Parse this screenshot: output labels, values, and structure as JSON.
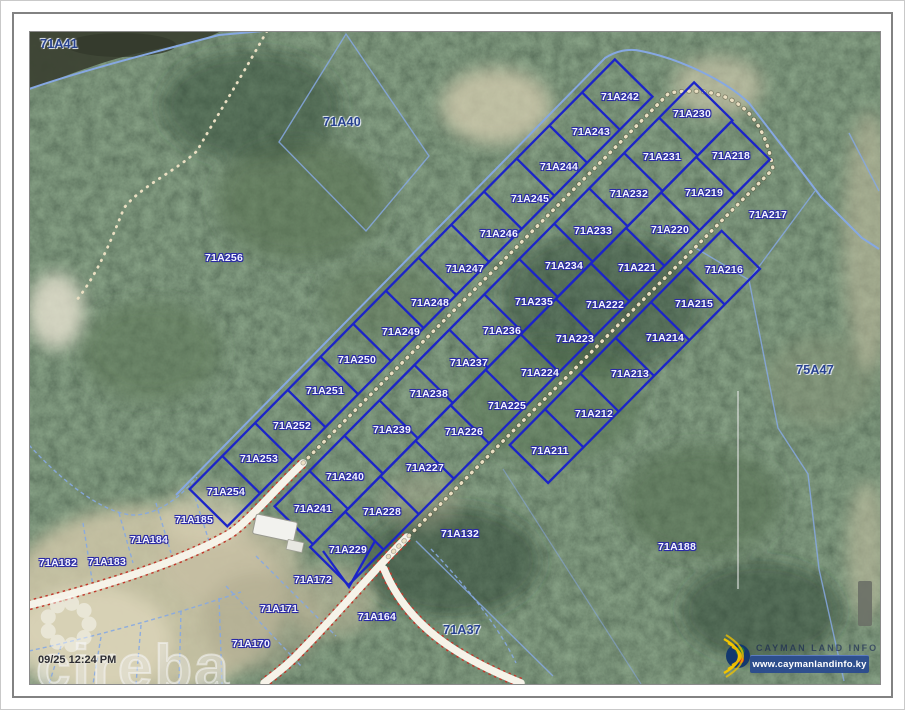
{
  "document": {
    "timestamp": "09/25 12:24 PM"
  },
  "watermark": {
    "brand": "cireba"
  },
  "branding": {
    "logo_text": "CAYMAN LAND INFO",
    "website": "www.caymanlandinfo.ky"
  },
  "colors": {
    "forest": "#41563f",
    "water": "#3c4233",
    "sand": "#d3cbae",
    "lot_boundary": "#1c24c8",
    "parcel_boundary": "#86a8e2",
    "road_fill": "#f6f3e9",
    "road_edge": "#c03a2c",
    "trail_dots": "#eadfc2",
    "label_minor": "#f5f5ff",
    "label_major": "#27418f"
  },
  "map": {
    "parcel_labels": [
      {
        "id": "71A41",
        "x": 57,
        "y": 42,
        "style": "major"
      },
      {
        "id": "71A40",
        "x": 340,
        "y": 120,
        "style": "major"
      },
      {
        "id": "71A256",
        "x": 222,
        "y": 256
      },
      {
        "id": "71A242",
        "x": 618,
        "y": 95
      },
      {
        "id": "71A230",
        "x": 690,
        "y": 112
      },
      {
        "id": "71A243",
        "x": 589,
        "y": 130
      },
      {
        "id": "71A231",
        "x": 660,
        "y": 155
      },
      {
        "id": "71A218",
        "x": 729,
        "y": 154
      },
      {
        "id": "71A244",
        "x": 557,
        "y": 165
      },
      {
        "id": "71A232",
        "x": 627,
        "y": 192
      },
      {
        "id": "71A219",
        "x": 702,
        "y": 191
      },
      {
        "id": "71A245",
        "x": 528,
        "y": 197
      },
      {
        "id": "71A217",
        "x": 766,
        "y": 213
      },
      {
        "id": "71A233",
        "x": 591,
        "y": 229
      },
      {
        "id": "71A220",
        "x": 668,
        "y": 228
      },
      {
        "id": "71A246",
        "x": 497,
        "y": 232
      },
      {
        "id": "71A247",
        "x": 463,
        "y": 267
      },
      {
        "id": "71A234",
        "x": 562,
        "y": 264
      },
      {
        "id": "71A221",
        "x": 635,
        "y": 266
      },
      {
        "id": "71A216",
        "x": 722,
        "y": 268
      },
      {
        "id": "71A248",
        "x": 428,
        "y": 301
      },
      {
        "id": "71A235",
        "x": 532,
        "y": 300
      },
      {
        "id": "71A222",
        "x": 603,
        "y": 303
      },
      {
        "id": "71A215",
        "x": 692,
        "y": 302
      },
      {
        "id": "71A249",
        "x": 399,
        "y": 330
      },
      {
        "id": "71A236",
        "x": 500,
        "y": 329
      },
      {
        "id": "71A223",
        "x": 573,
        "y": 337
      },
      {
        "id": "71A214",
        "x": 663,
        "y": 336
      },
      {
        "id": "71A250",
        "x": 355,
        "y": 358
      },
      {
        "id": "71A237",
        "x": 467,
        "y": 361
      },
      {
        "id": "71A224",
        "x": 538,
        "y": 371
      },
      {
        "id": "71A213",
        "x": 628,
        "y": 372
      },
      {
        "id": "71A251",
        "x": 323,
        "y": 389
      },
      {
        "id": "71A238",
        "x": 427,
        "y": 392
      },
      {
        "id": "71A225",
        "x": 505,
        "y": 404
      },
      {
        "id": "71A212",
        "x": 592,
        "y": 412
      },
      {
        "id": "71A252",
        "x": 290,
        "y": 424
      },
      {
        "id": "71A239",
        "x": 390,
        "y": 428
      },
      {
        "id": "71A226",
        "x": 462,
        "y": 430
      },
      {
        "id": "71A253",
        "x": 257,
        "y": 457
      },
      {
        "id": "71A240",
        "x": 343,
        "y": 475
      },
      {
        "id": "71A227",
        "x": 423,
        "y": 466
      },
      {
        "id": "71A211",
        "x": 548,
        "y": 449
      },
      {
        "id": "71A254",
        "x": 224,
        "y": 490
      },
      {
        "id": "71A241",
        "x": 311,
        "y": 507
      },
      {
        "id": "71A228",
        "x": 380,
        "y": 510
      },
      {
        "id": "71A229",
        "x": 346,
        "y": 548
      },
      {
        "id": "71A185",
        "x": 192,
        "y": 518
      },
      {
        "id": "71A184",
        "x": 147,
        "y": 538
      },
      {
        "id": "71A183",
        "x": 105,
        "y": 560
      },
      {
        "id": "71A182",
        "x": 56,
        "y": 561
      },
      {
        "id": "71A132",
        "x": 458,
        "y": 532
      },
      {
        "id": "71A172",
        "x": 311,
        "y": 578
      },
      {
        "id": "71A171",
        "x": 277,
        "y": 607
      },
      {
        "id": "71A164",
        "x": 375,
        "y": 615
      },
      {
        "id": "71A170",
        "x": 249,
        "y": 642
      },
      {
        "id": "71A37",
        "x": 460,
        "y": 628,
        "style": "major"
      },
      {
        "id": "71A188",
        "x": 675,
        "y": 545
      },
      {
        "id": "75A47",
        "x": 813,
        "y": 368,
        "style": "major"
      }
    ]
  }
}
